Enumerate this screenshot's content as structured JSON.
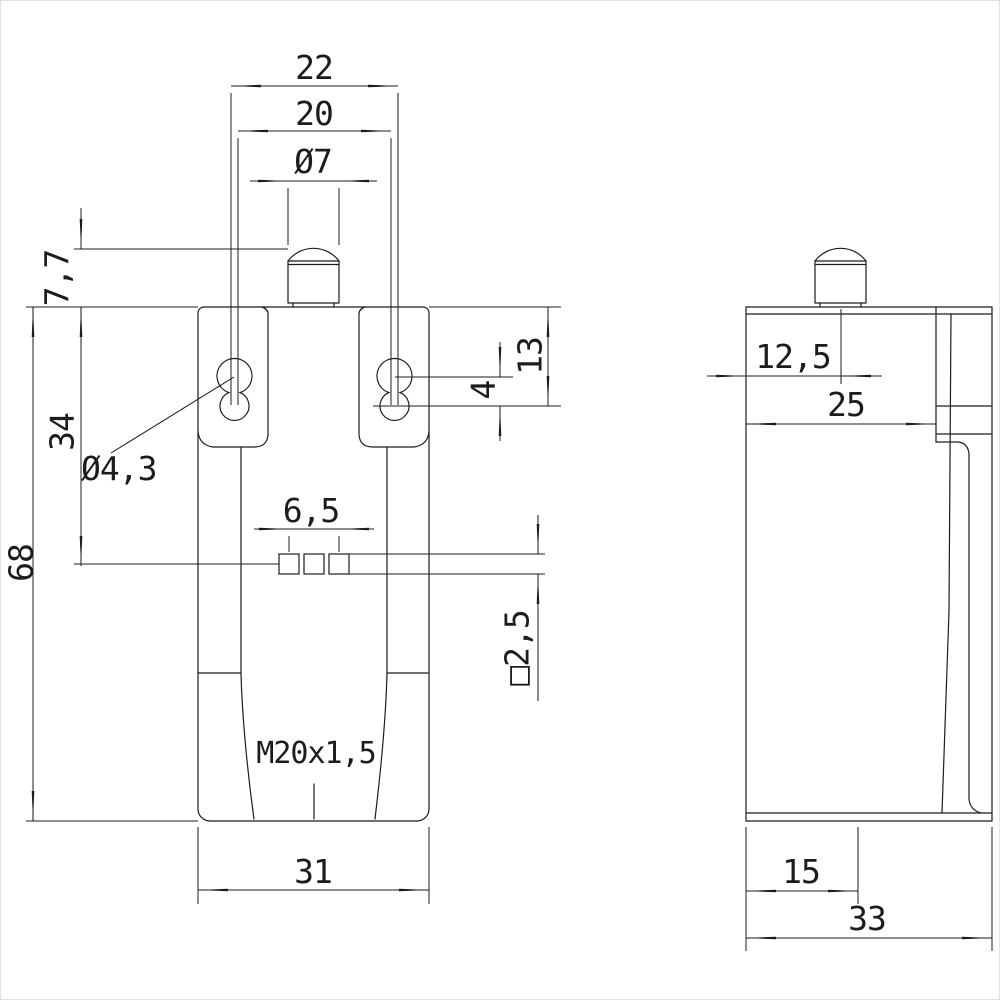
{
  "drawing": {
    "kind": "technical dimensional drawing, limit switch housing",
    "line_color": "#1c1c1c",
    "background": "#ffffff",
    "views": {
      "front": {
        "label": "front-view",
        "dims": {
          "top_width": "22",
          "hole_spacing": "20",
          "plunger_diameter": "Ø7",
          "plunger_height": "7,7",
          "hole_depth": "13",
          "hole_offset": "4",
          "upper_section_height": "34",
          "mounting_hole_diameter": "Ø4,3",
          "overall_height": "68",
          "contact_spacing": "6,5",
          "contact_square": "□2,5",
          "thread_spec": "M20x1,5",
          "body_width": "31"
        }
      },
      "side": {
        "label": "side-view",
        "dims": {
          "plunger_axis_offset": "12,5",
          "upper_depth": "25",
          "bottom_step_offset": "15",
          "body_depth": "33"
        }
      }
    }
  }
}
